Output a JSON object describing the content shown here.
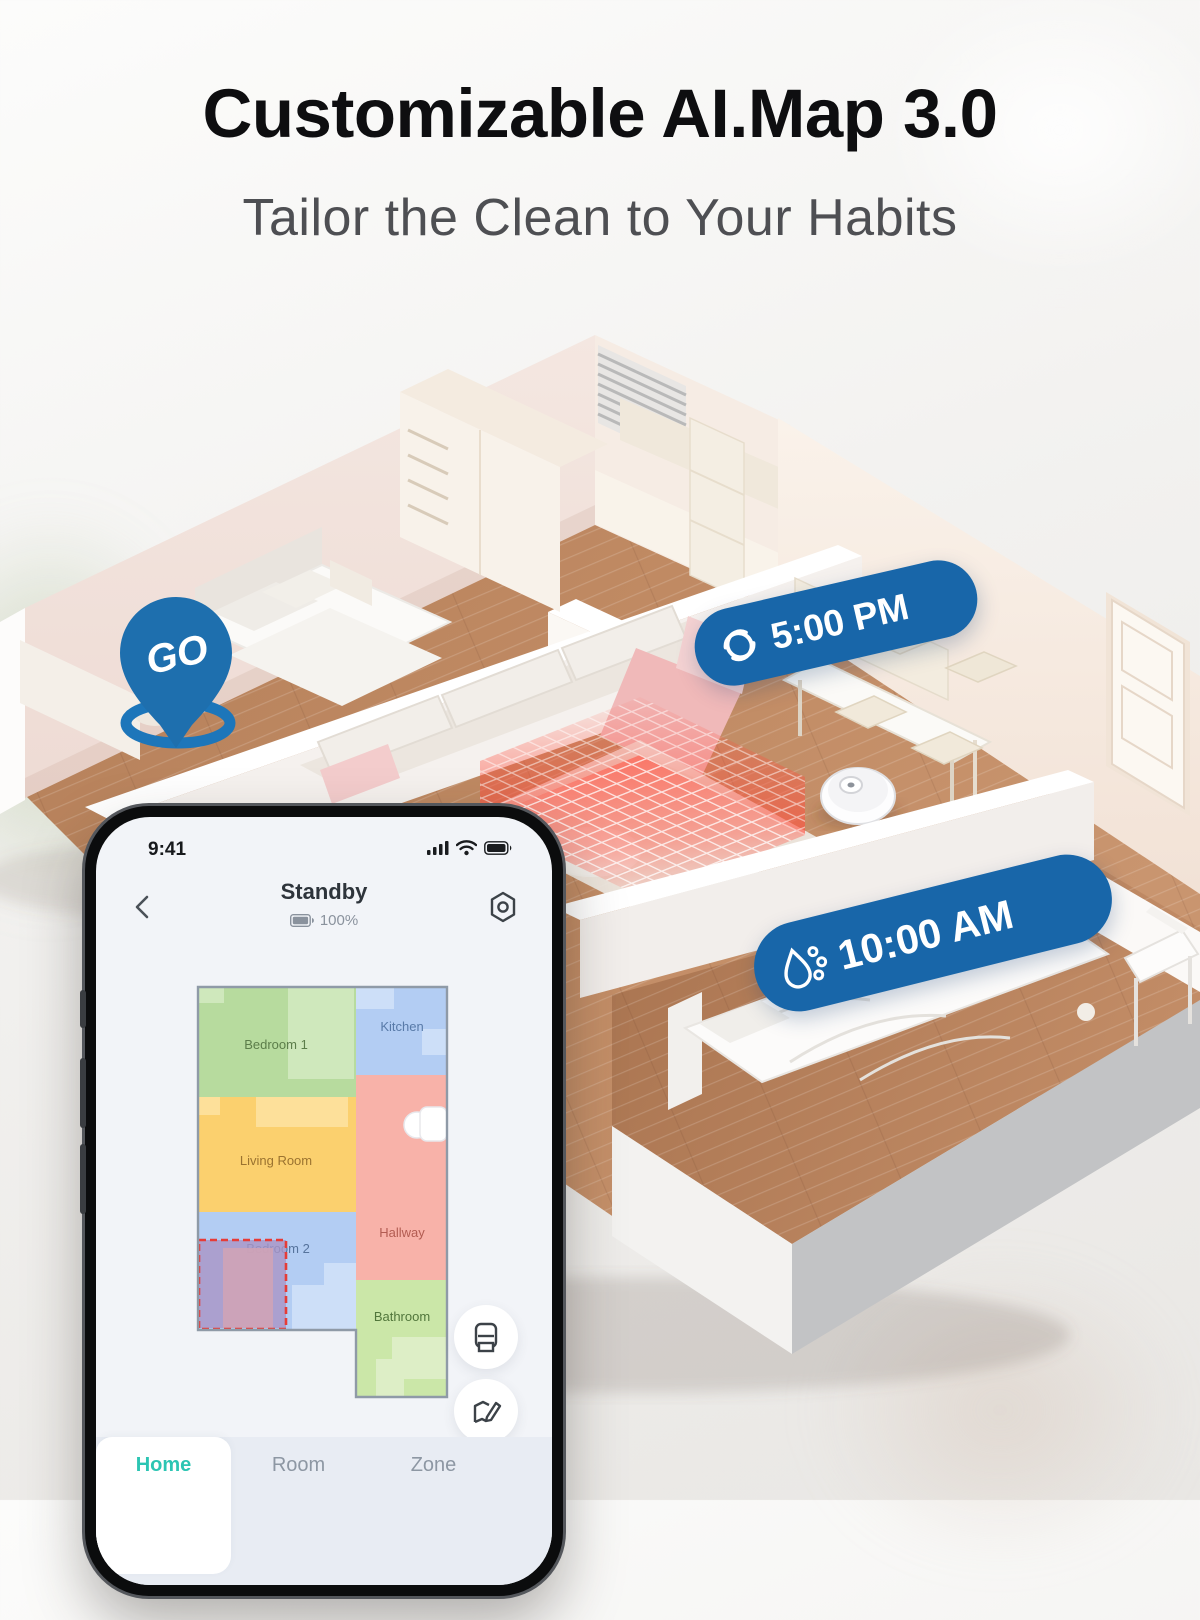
{
  "page": {
    "title": "Customizable AI.Map 3.0",
    "subtitle": "Tailor the Clean to Your Habits"
  },
  "scene": {
    "go_pin_label": "GO",
    "schedules": [
      {
        "icon": "vacuum-swirl-icon",
        "time": "5:00 PM"
      },
      {
        "icon": "mop-drops-icon",
        "time": "10:00 AM"
      }
    ],
    "colors": {
      "badge_blue": "#1866A9",
      "pin_blue": "#1E6FAE",
      "no_go_zone_red": "#E63B33"
    }
  },
  "phone": {
    "status_bar": {
      "time": "9:41"
    },
    "header": {
      "status": "Standby",
      "battery_percent": "100%"
    },
    "map": {
      "rooms": [
        {
          "name": "Bedroom 1",
          "color": "#B7DB9E"
        },
        {
          "name": "Kitchen",
          "color": "#B3CDF3"
        },
        {
          "name": "Living Room",
          "color": "#FBD06E"
        },
        {
          "name": "Hallway",
          "color": "#F8B2A9"
        },
        {
          "name": "Bedroom 2",
          "color": "#B3CDF3"
        },
        {
          "name": "Bathroom",
          "color": "#CBE7A8"
        }
      ],
      "selection": {
        "room": "Bedroom 2",
        "border_color": "#E63C38",
        "fill_color": "#A995C5"
      }
    },
    "tabs": [
      {
        "label": "Home",
        "active": true
      },
      {
        "label": "Room",
        "active": false
      },
      {
        "label": "Zone",
        "active": false
      }
    ],
    "accent_teal": "#2CC5B3"
  }
}
